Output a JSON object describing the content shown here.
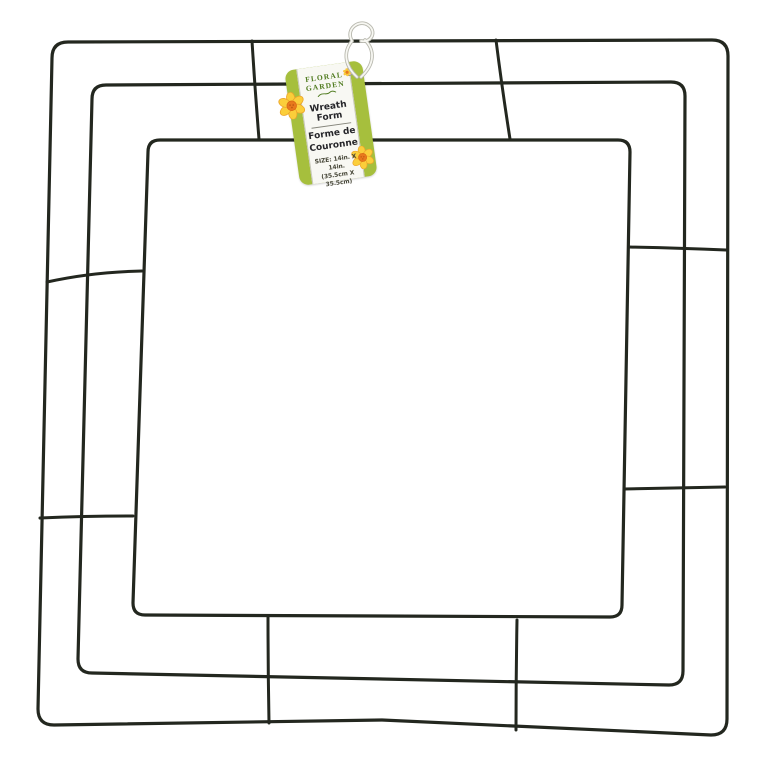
{
  "scene": {
    "background_color": "#ffffff",
    "wire_color": "#23271f"
  },
  "tag": {
    "brand": {
      "line1": "FLORAL",
      "line2": "GARDEN"
    },
    "product_name_en": "Wreath Form",
    "product_name_fr_line1": "Forme de",
    "product_name_fr_line2": "Couronne",
    "size_line1": "SIZE: 14in. X 14in.",
    "size_line2": "(35.5cm X 35.5cm)",
    "colors": {
      "tag_green": "#a6bf3d",
      "panel_white": "#f8f8f3",
      "logo_green": "#4e7a1d",
      "text_dark": "#26262a",
      "size_text": "#474738",
      "flower_yellow": "#fbce3a",
      "flower_orange": "#e8791d",
      "string_white": "#f7f7f2",
      "string_edge": "#b8b8ae"
    }
  }
}
